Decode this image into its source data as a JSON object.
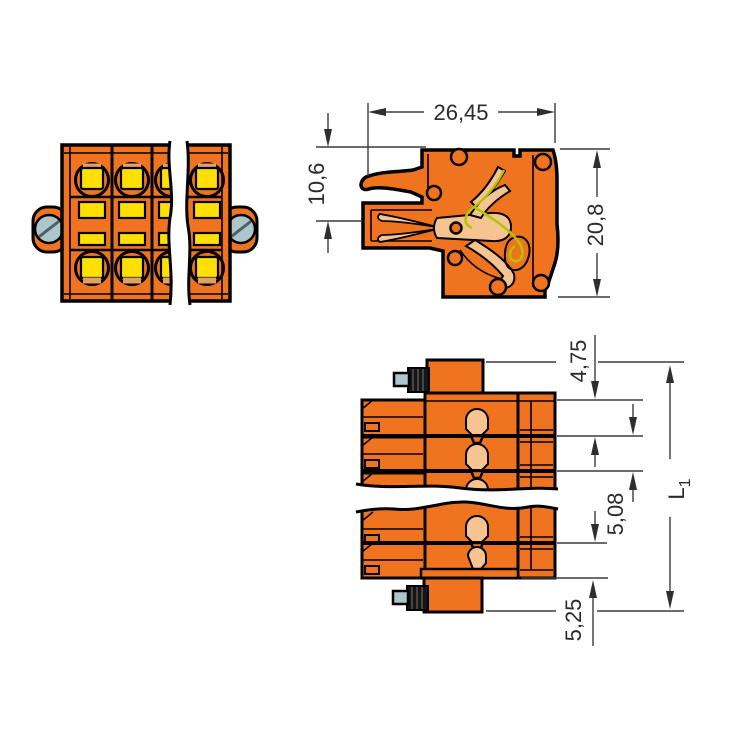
{
  "drawing": {
    "background_color": "#FFFFFF",
    "colors": {
      "housing_orange": "#F0741F",
      "button_yellow": "#FFE000",
      "contact_copper": "#F6C491",
      "metal_tan": "#DFA167",
      "screw_head_gray": "#ACC6CC",
      "spring_green": "#B4C400",
      "screw_anchor_black": "#161616",
      "outline_black": "#000000",
      "dimension_gray": "#3C3C3C"
    },
    "dimensions": {
      "section_width": "26,45",
      "latch_to_wire_axis": "10,6",
      "section_height": "20,8",
      "screw_top_offset": "4,75",
      "pole_pitch": "5,08",
      "screw_bottom_offset": "5,25",
      "total_length": {
        "base": "L",
        "subscript": "1"
      }
    }
  }
}
